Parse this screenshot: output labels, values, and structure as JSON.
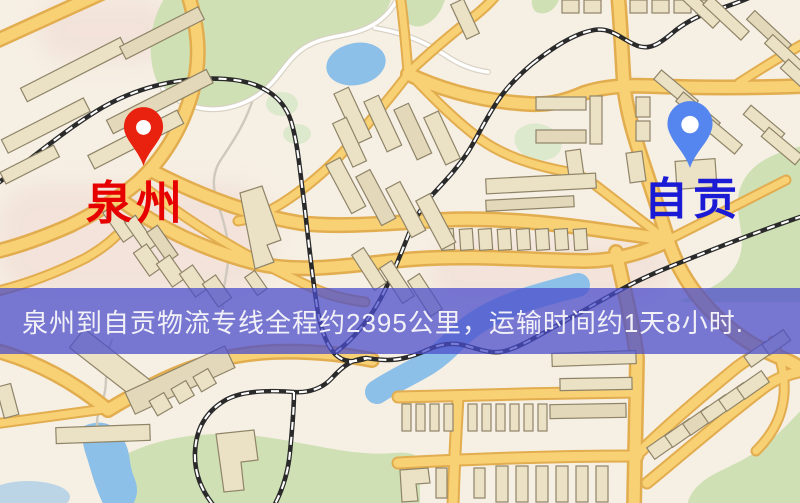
{
  "map": {
    "markers": [
      {
        "city": "泉州",
        "role": "origin",
        "pin_color": "#e8220f",
        "label_color": "#e60000"
      },
      {
        "city": "自贡",
        "role": "destination",
        "pin_color": "#5585ee",
        "label_color": "#1b1bd6"
      }
    ]
  },
  "banner": {
    "text": "泉州到自贡物流专线全程约2395公里，运输时间约1天8小时.",
    "distance_km": "2395",
    "duration": "1天8小时"
  },
  "theme": {
    "banner-bg": "rgba(74,77,204,0.74)",
    "banner-text": "#f2f1f7",
    "origin-label": "#e60000",
    "dest-label": "#1b1bd6",
    "map-bg": "#f6efe4",
    "road-fill": "#f8d175",
    "road-casing": "#e2ad4f",
    "green": "#cfe0b5",
    "water": "#8cc0e8",
    "rail": "#2a2a2a",
    "building": "#ebe2c6"
  }
}
